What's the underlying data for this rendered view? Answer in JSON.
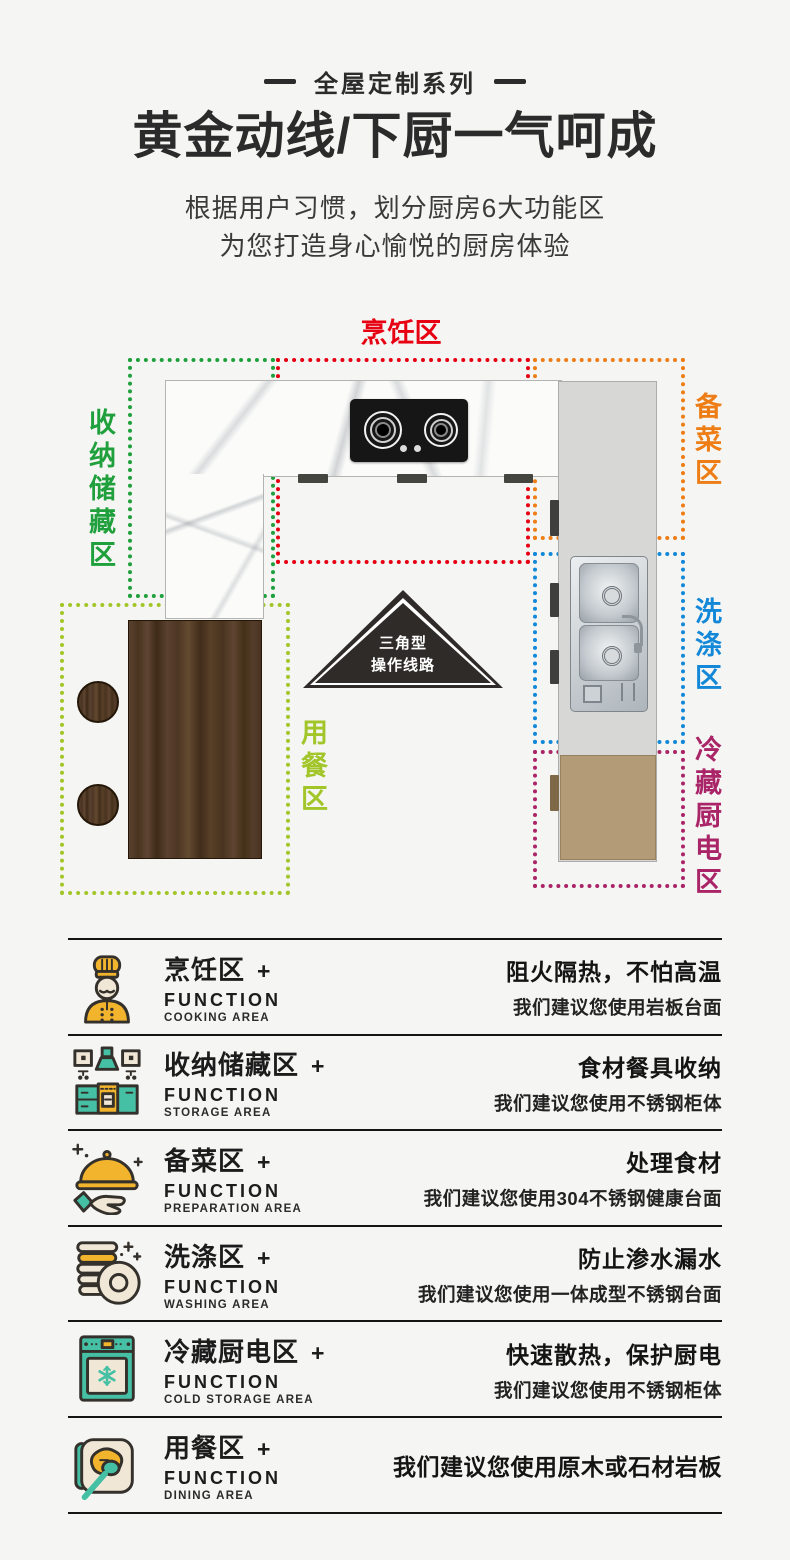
{
  "palette": {
    "background": "#f5f5f3",
    "text_dark": "#2b2b2b",
    "icon_teal": "#46c0a4",
    "icon_yellow": "#f2b42d",
    "icon_beige": "#f0e7d6",
    "wood_brown": "#50392a",
    "cabinet_tan": "#b39b78"
  },
  "header": {
    "series_label": "全屋定制系列",
    "title": "黄金动线/下厨一气呵成",
    "subtitle_line1": "根据用户习惯，划分厨房6大功能区",
    "subtitle_line2": "为您打造身心愉悦的厨房体验"
  },
  "diagram": {
    "triangle": {
      "line1": "三角型",
      "line2": "操作线路"
    },
    "zones": [
      {
        "id": "cooking",
        "label": "烹饪区",
        "color": "#e60012"
      },
      {
        "id": "storage",
        "label": "收纳储藏区",
        "color": "#1fa03c"
      },
      {
        "id": "prep",
        "label": "备菜区",
        "color": "#ed7d14"
      },
      {
        "id": "washing",
        "label": "洗涤区",
        "color": "#1488d8"
      },
      {
        "id": "cold",
        "label": "冷藏厨电区",
        "color": "#aa2568"
      },
      {
        "id": "dining",
        "label": "用餐区",
        "color": "#a2c62a"
      }
    ]
  },
  "functions": {
    "function_label": "FUNCTION",
    "plus": "+",
    "rows": [
      {
        "icon": "chef-icon",
        "title": "烹饪区",
        "area_en": "COOKING AREA",
        "benefit": "阻火隔热，不怕高温",
        "suggestion": "我们建议您使用岩板台面"
      },
      {
        "icon": "cabinet-icon",
        "title": "收纳储藏区",
        "area_en": "STORAGE AREA",
        "benefit": "食材餐具收纳",
        "suggestion": "我们建议您使用不锈钢柜体"
      },
      {
        "icon": "cloche-icon",
        "title": "备菜区",
        "area_en": "PREPARATION AREA",
        "benefit": "处理食材",
        "suggestion": "我们建议您使用304不锈钢健康台面"
      },
      {
        "icon": "plates-icon",
        "title": "洗涤区",
        "area_en": "WASHING AREA",
        "benefit": "防止渗水漏水",
        "suggestion": "我们建议您使用一体成型不锈钢台面"
      },
      {
        "icon": "fridge-icon",
        "title": "冷藏厨电区",
        "area_en": "COLD STORAGE AREA",
        "benefit": "快速散热，保护厨电",
        "suggestion": "我们建议您使用不锈钢柜体"
      },
      {
        "icon": "dining-icon",
        "title": "用餐区",
        "area_en": "DINING AREA",
        "benefit": "",
        "suggestion": "我们建议您使用原木或石材岩板"
      }
    ]
  }
}
